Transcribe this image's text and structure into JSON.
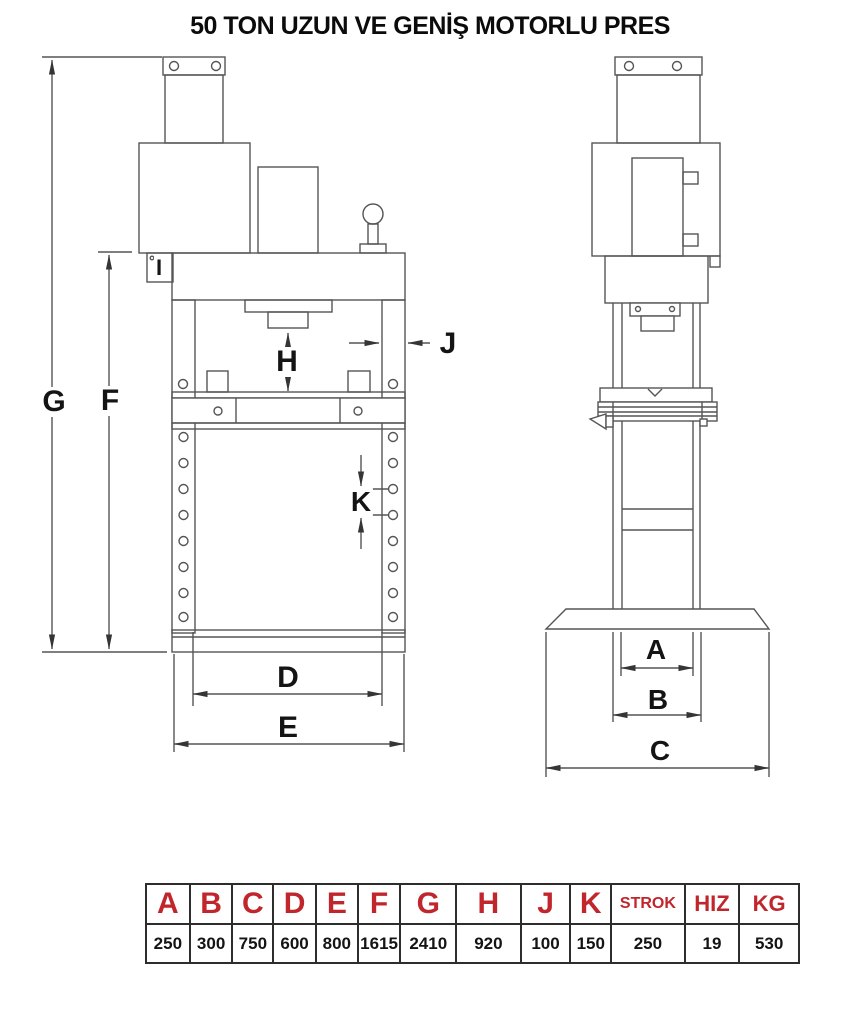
{
  "title": "50 TON UZUN VE GENİŞ MOTORLU PRES",
  "colors": {
    "line": "#555555",
    "label_text": "#141414",
    "table_header_red": "#c0262c",
    "table_border": "#2d2d2d",
    "background": "#ffffff"
  },
  "dims": {
    "g": "G",
    "f": "F",
    "i": "I",
    "h": "H",
    "j": "J",
    "k": "K",
    "d": "D",
    "e": "E",
    "a": "A",
    "b": "B",
    "c": "C"
  },
  "table": {
    "columns": [
      {
        "header": "A",
        "value": "250"
      },
      {
        "header": "B",
        "value": "300"
      },
      {
        "header": "C",
        "value": "750"
      },
      {
        "header": "D",
        "value": "600"
      },
      {
        "header": "E",
        "value": "800"
      },
      {
        "header": "F",
        "value": "1615"
      },
      {
        "header": "G",
        "value": "2410"
      },
      {
        "header": "H",
        "value": "920"
      },
      {
        "header": "J",
        "value": "100"
      },
      {
        "header": "K",
        "value": "150"
      },
      {
        "header": "STROK",
        "value": "250"
      },
      {
        "header": "HIZ",
        "value": "19"
      },
      {
        "header": "KG",
        "value": "530"
      }
    ]
  }
}
